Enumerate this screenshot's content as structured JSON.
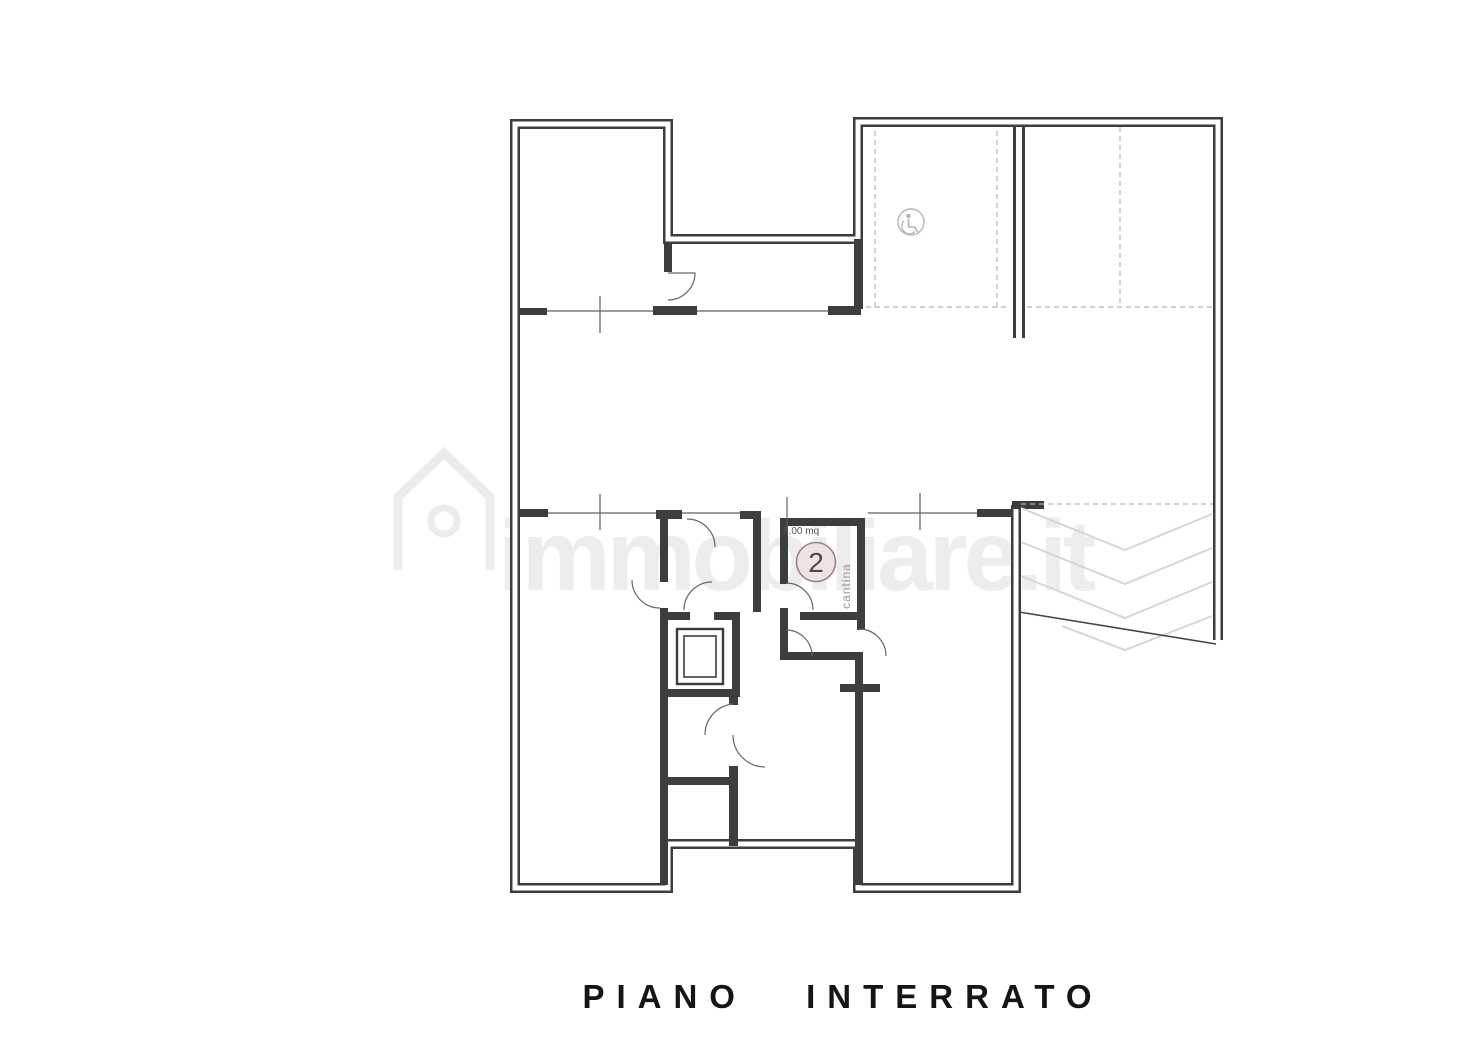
{
  "page": {
    "background_color": "#ffffff"
  },
  "plan": {
    "title": "PIANO INTERRATO",
    "watermark_text": "immobiliare.it",
    "cantina": {
      "area_label": "5.00 mq",
      "unit_number": "2",
      "room_label": "cantina"
    },
    "symbols": {
      "accessible_parking_icon": "wheelchair-icon"
    },
    "colors": {
      "wall": "#3d3d3d",
      "thin_line": "#5f5f5f",
      "dashed_line": "#b3b3b3",
      "chevron": "#d6d6d6",
      "watermark": "#ececec",
      "unit_circle_fill": "#f3e2e2",
      "unit_circle_stroke": "#9b8484",
      "title_color": "#151515"
    }
  }
}
